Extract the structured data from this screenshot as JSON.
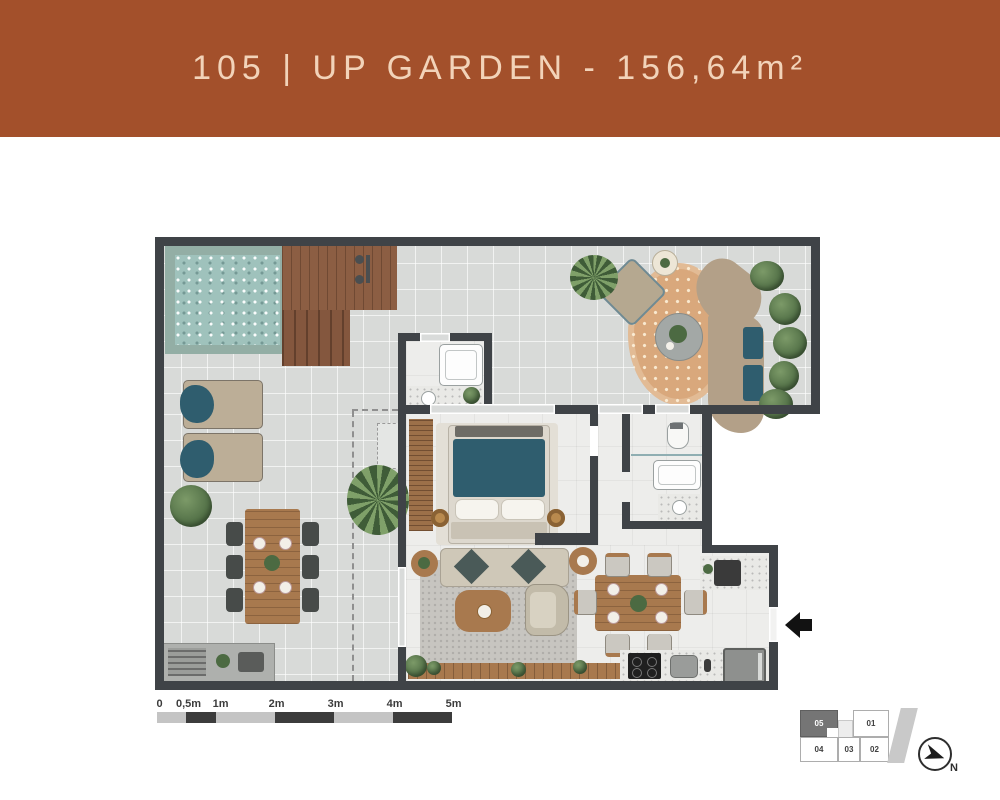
{
  "header": {
    "title": "105 | UP GARDEN - 156,64m²"
  },
  "floor_plan": {
    "unit": "105",
    "name": "UP GARDEN",
    "area_label": "156,64m²"
  },
  "colors": {
    "header-bg": "#A3502B",
    "header-text": "#F2D3B9",
    "wall": "#3F4347",
    "terrace-tile": "#D8DAD8",
    "interior-floor": "#EDEDEB",
    "pool-water": "#9FC2BC",
    "pool-coping": "#93AEA5",
    "deck-wood": "#8C5E43",
    "rug-tan": "#D9A87C",
    "furniture-wood": "#A8794E",
    "upholstery-teal": "#2F5D6E",
    "plant-green": "#55754A",
    "scale-dark": "#3C3C3C",
    "scale-light": "#C4C4C4"
  },
  "scale_bar": {
    "labels": [
      "0",
      "0,5m",
      "1m",
      "2m",
      "3m",
      "4m",
      "5m"
    ]
  },
  "key_plan": {
    "units": [
      {
        "id": "05",
        "highlighted": true
      },
      {
        "id": "01",
        "highlighted": false
      },
      {
        "id": "04",
        "highlighted": false
      },
      {
        "id": "03",
        "highlighted": false
      },
      {
        "id": "02",
        "highlighted": false
      }
    ]
  },
  "compass": {
    "label": "N"
  }
}
